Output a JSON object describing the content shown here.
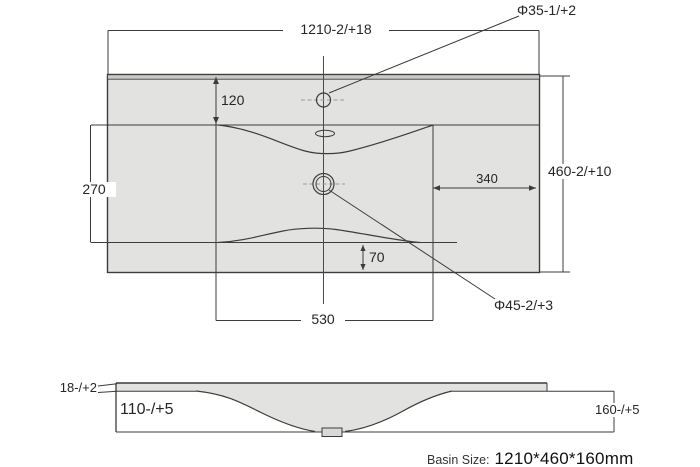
{
  "drawing": {
    "title_hint": "basin technical drawing",
    "top_view": {
      "overall_width": "1210-2/+18",
      "overall_depth": "460-2/+10",
      "faucet_hole_diameter": "Φ35-1/+2",
      "drain_hole_diameter": "Φ45-2/+3",
      "rim_offset_top": "120",
      "basin_opening_depth": "270",
      "side_margin_right": "340",
      "basin_opening_width": "530",
      "rim_offset_bottom": "70"
    },
    "side_view": {
      "deck_thickness": "18-/+2",
      "under_deck_clearance": "110-/+5",
      "total_height": "160-/+5"
    },
    "caption": {
      "label": "Basin Size:",
      "value": "1210*460*160mm"
    },
    "colors": {
      "surface_fill": "#e2e2e0",
      "edge_band_fill": "#c9c9c7",
      "line": "#3c3c3c",
      "centerline_dash": "#9a9a98",
      "background": "#ffffff"
    }
  }
}
